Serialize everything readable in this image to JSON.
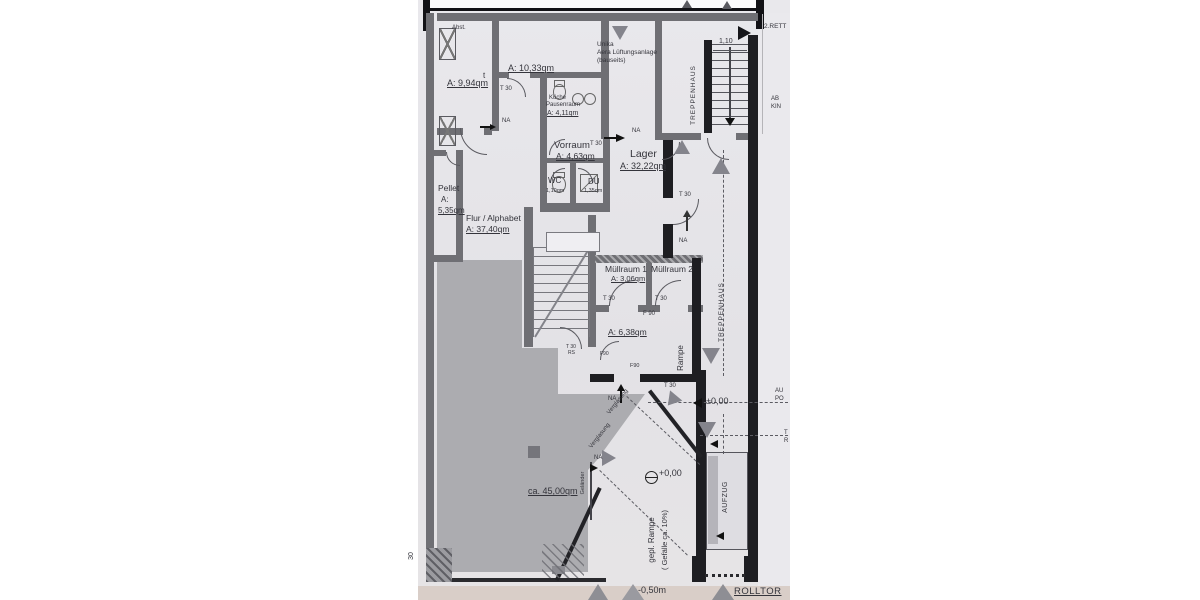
{
  "colors": {
    "paper": "#e6e5e8",
    "wall_gray": "#6f6f74",
    "wall_black": "#1e1e22",
    "floor_shade": "#a7a7ab",
    "scan_band_pink": "#d9cec8",
    "arrow_gray": "#84848c",
    "ink": "#34343b"
  },
  "labels": {
    "abst": "Abst.",
    "sym": "t",
    "a994": "A: 9,94qm",
    "a1033": "A: 10,33qm",
    "kueche": "Küche",
    "pausenraum": "Pausenraum",
    "a411": "A: 4,11qm",
    "unika1": "Unika",
    "unika2": "Aera Lüftungsanlage",
    "unika3": "(bauseits)",
    "vorraum": "Vorraum",
    "a463": "A: 4,63qm",
    "lager": "Lager",
    "a3222": "A: 32,22qm",
    "wc": "WC",
    "wc_area": "1,10qm",
    "du": "DU",
    "du_area": "1,35qm",
    "pellet": "Pellet",
    "pellet_a": "A:",
    "pellet_area": "5,35qm",
    "flur": "Flur / Alphabet",
    "flur_area": "A: 37,40qm",
    "muell1": "Müllraum 1",
    "muell1_area": "A: 3,06qm",
    "muell2": "Müllraum 2",
    "a638": "A: 6,38qm",
    "verkauf_area": "ca. 45,00qm",
    "minus050": "-0,50m",
    "rolltor": "ROLLTOR",
    "pm000": "±0,00",
    "p000": "+0,00",
    "dim110": "1,10",
    "dim30": "30",
    "rett": "2.RETT",
    "ab": "AB",
    "kin": "KIN",
    "au": "AU",
    "po": "PO",
    "t_cut": "T",
    "r_cut": "R"
  },
  "tags": {
    "t30": "T 30",
    "rs": "RS",
    "f90": "F 90",
    "f90s": "F90",
    "na": "NA"
  },
  "vertical": {
    "treppenhaus": "TREPPENHAUS",
    "rampe": "Rampe",
    "aufzug": "AUFZUG",
    "gepl_rampe": "gepl. Rampe",
    "gefaelle": "( Gefälle ca. 10%)",
    "verglasung": "Verglasung",
    "gelaender": "Geländer"
  }
}
